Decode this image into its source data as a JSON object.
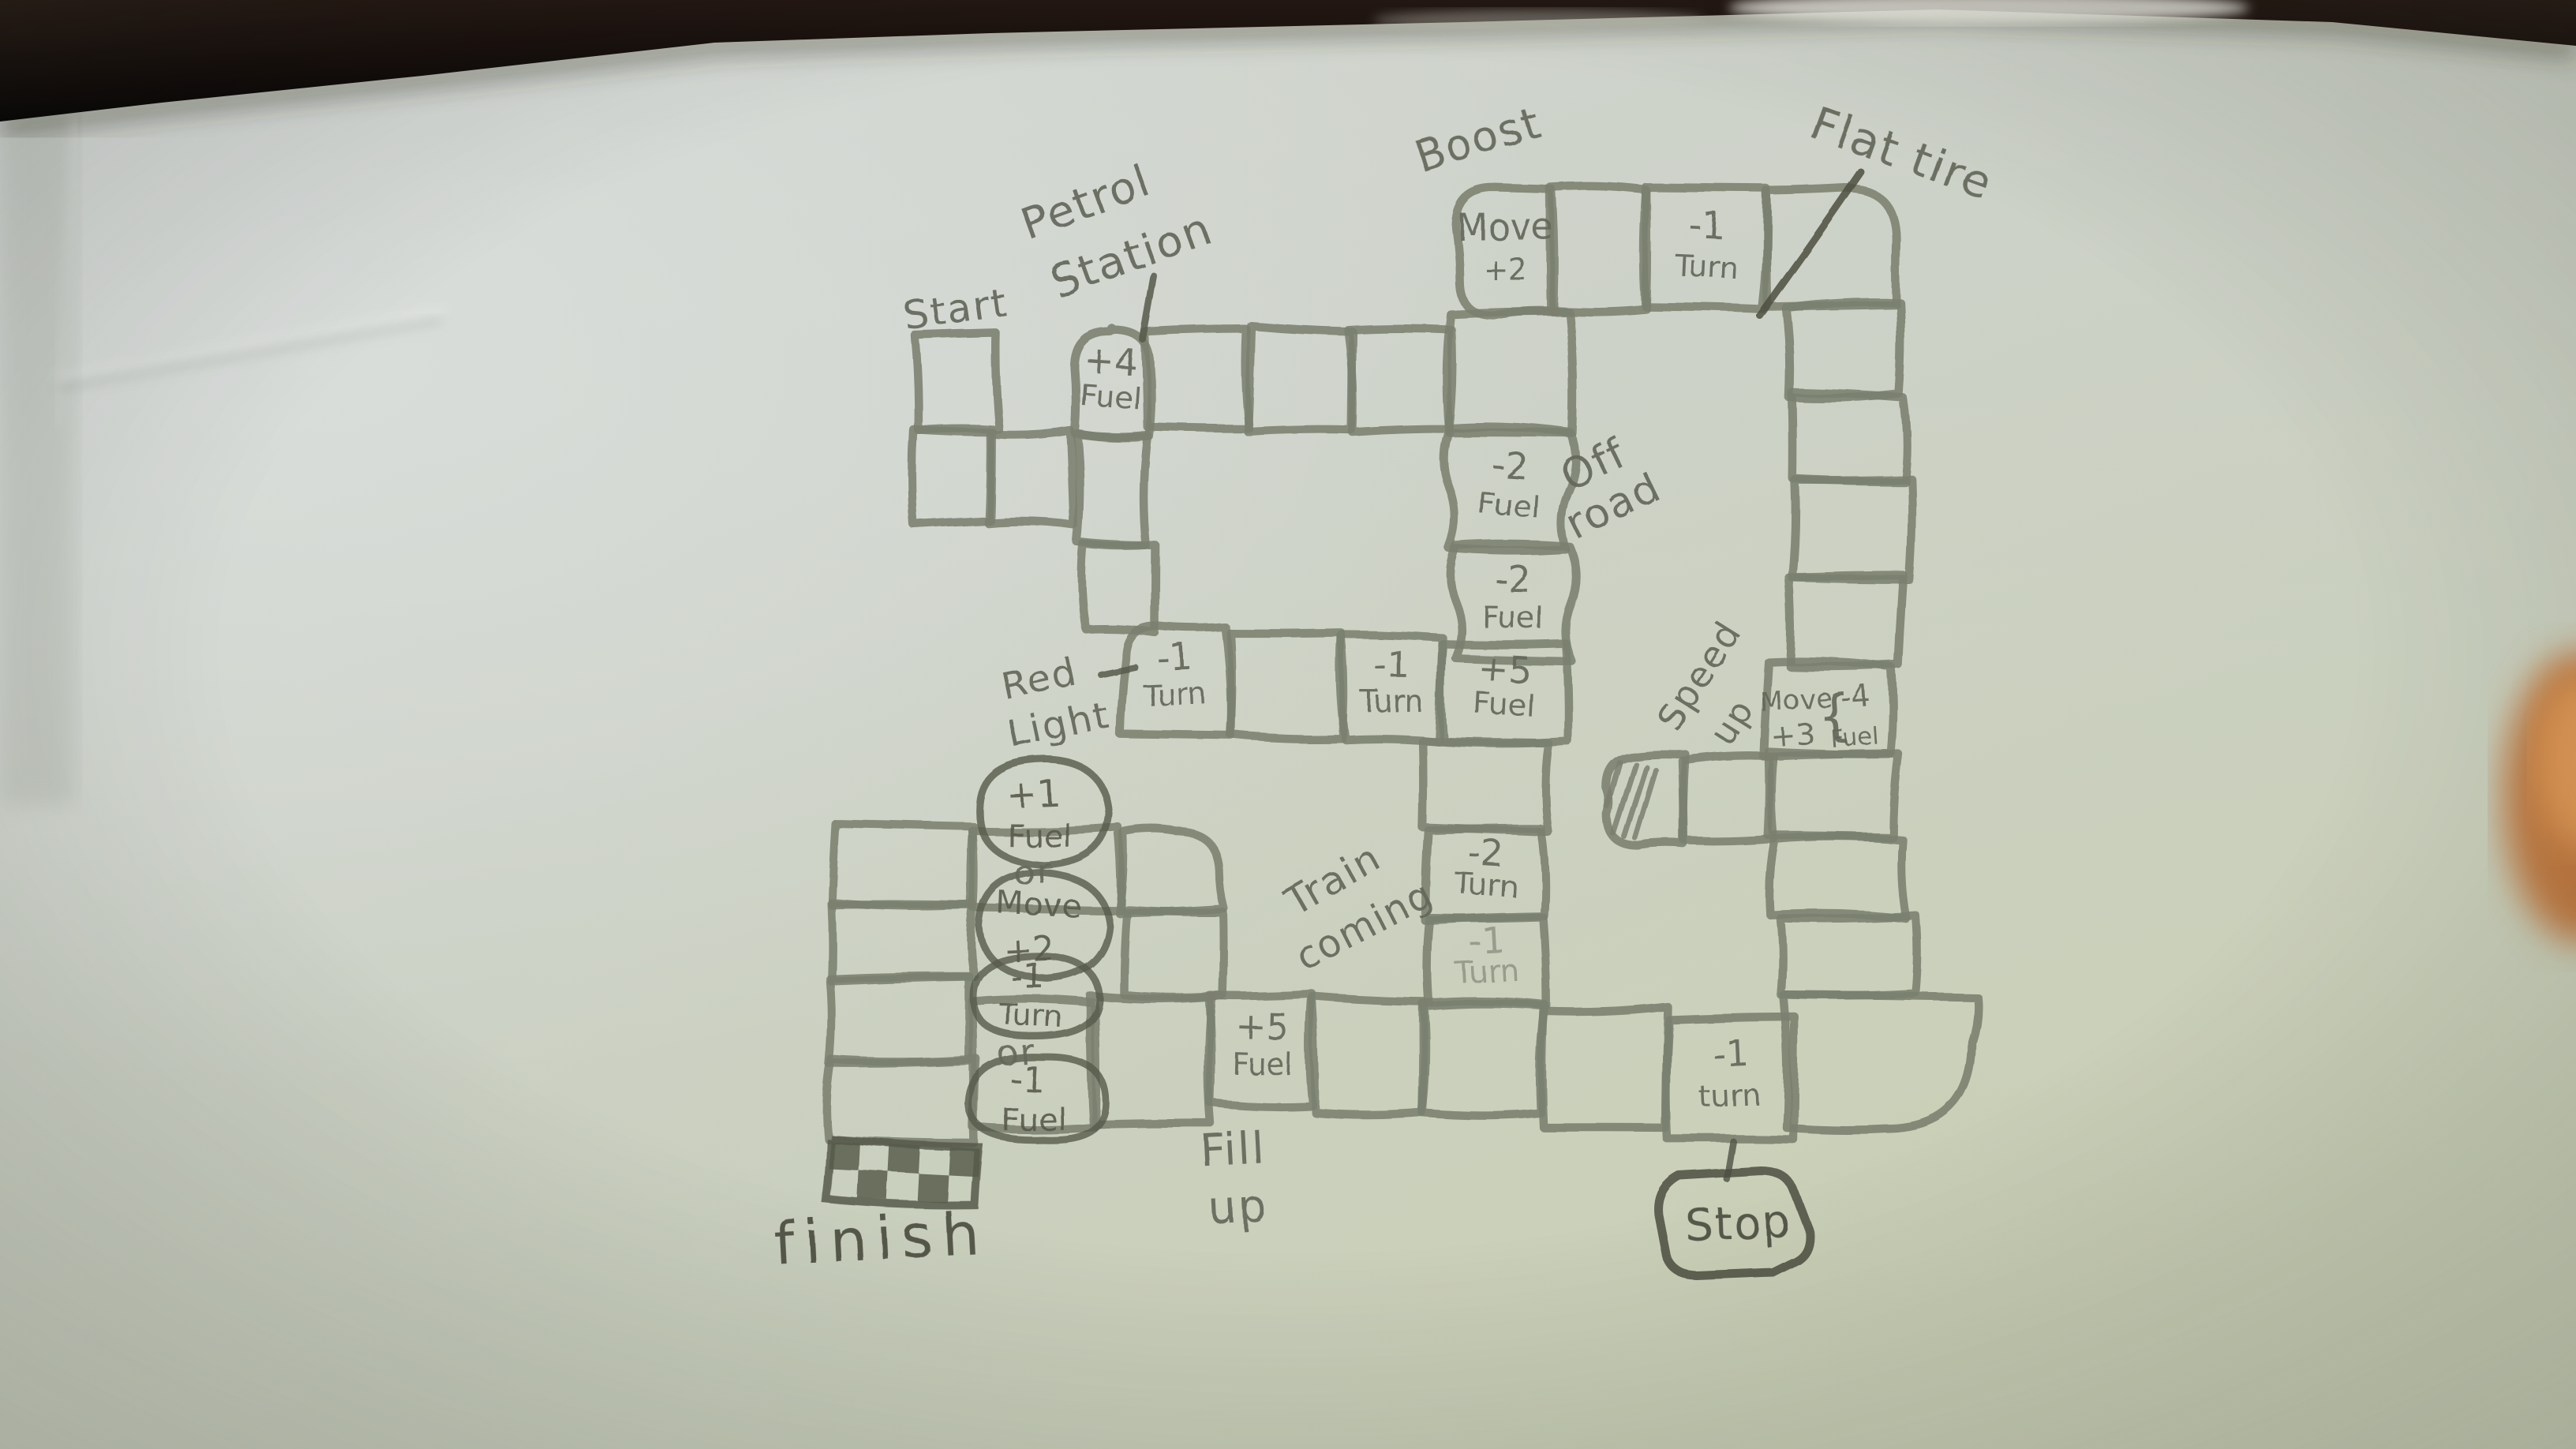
{
  "photo": {
    "type": "hand-drawn board game on paper",
    "colors": {
      "paper": "#cdd2c8",
      "pencil": "#7b7f6e",
      "pencil_dark": "#565a4b",
      "table": "#160f0a",
      "finger_blur": "#d08a4e"
    }
  },
  "labels": {
    "start": [
      "Start"
    ],
    "petrol_station": [
      "Petrol",
      "Station"
    ],
    "boost": [
      "Boost"
    ],
    "flat_tire": [
      "Flat tire"
    ],
    "off_road": [
      "Off",
      "road"
    ],
    "red_light": [
      "Red",
      "Light"
    ],
    "speed_up": [
      "Speed",
      "up"
    ],
    "train_coming": [
      "Train",
      "coming"
    ],
    "fill_up": [
      "Fill",
      "up"
    ],
    "finish": [
      "finish"
    ],
    "stop": [
      "Stop"
    ]
  },
  "cells": {
    "fuel_plus4": [
      "+4",
      "Fuel"
    ],
    "move_plus2": [
      "Move",
      "+2"
    ],
    "turn_minus1_top": [
      "-1",
      "Turn"
    ],
    "fuel_minus2_a": [
      "-2",
      "Fuel"
    ],
    "fuel_minus2_b": [
      "-2",
      "Fuel"
    ],
    "turn_minus1_redlight": [
      "-1",
      "Turn"
    ],
    "turn_minus1_mid": [
      "-1",
      "Turn"
    ],
    "fuel_plus5_mid": [
      "+5",
      "Fuel"
    ],
    "move_plus3_fuel_minus4": [
      "Move",
      "+3",
      "{",
      "-4",
      "Fuel"
    ],
    "turn_minus2_train": [
      "-2",
      "Turn"
    ],
    "turn_minus1_train": [
      "-1",
      "Turn"
    ],
    "fuel_plus5_bottom": [
      "+5",
      "Fuel"
    ],
    "turn_minus1_bottom": [
      "-1",
      "turn"
    ]
  },
  "choice_bubbles": {
    "bubble1": [
      "+1",
      "Fuel"
    ],
    "or_1": "or",
    "bubble2": [
      "Move",
      "+2"
    ],
    "bubble3": [
      "-1",
      "Turn"
    ],
    "or_2": "or",
    "bubble4": [
      "-1",
      "Fuel"
    ]
  }
}
